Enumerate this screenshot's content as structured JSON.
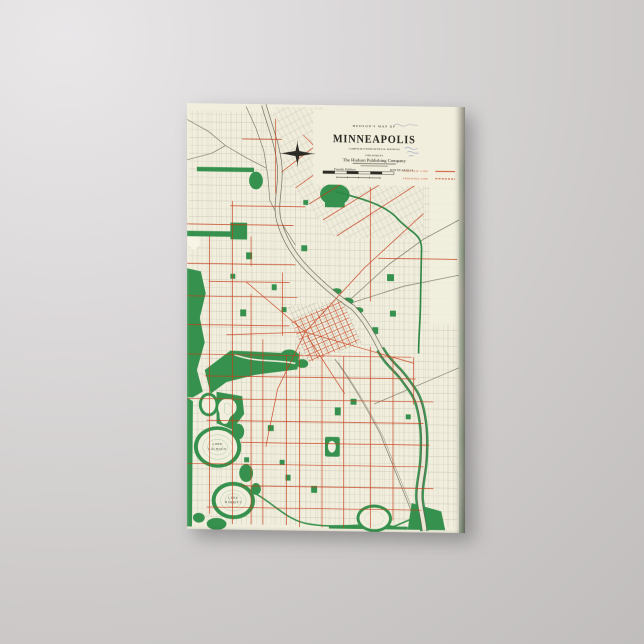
{
  "product": {
    "type": "gallery-wrapped canvas print on wall",
    "wall_color_top": "#e3e1e2",
    "wall_color_bottom": "#bab7b6",
    "canvas_paper_color": "#f1eedd"
  },
  "map": {
    "header": {
      "kicker": "HUDSON'S MAP OF",
      "title": "MINNEAPOLIS",
      "subtitle": "COMPILED FROM OFFICIAL SOURCES",
      "published_by_label": "PUBLISHED BY",
      "publisher": "The Hudson Publishing Company",
      "edition": "Fourth Edition",
      "edition_city": "MINNEAPOLIS"
    },
    "legend": {
      "items": [
        {
          "label": "ELECTRIC LINE",
          "line_style": "solid"
        },
        {
          "label": "PROPOSED LINE",
          "line_style": "dashed"
        }
      ]
    },
    "labels": {
      "lake_calhoun": [
        "LAKE",
        "CALHOUN"
      ],
      "lake_harriet": [
        "LAKE",
        "HARRIET"
      ]
    },
    "colors": {
      "paper": "#f1eedd",
      "park_green": "#35914d",
      "streetcar_red": "#c83d1a",
      "street_gray": "#8e8b7a",
      "railroad_gray": "#74715f",
      "ink_black": "#2b2a24"
    }
  }
}
